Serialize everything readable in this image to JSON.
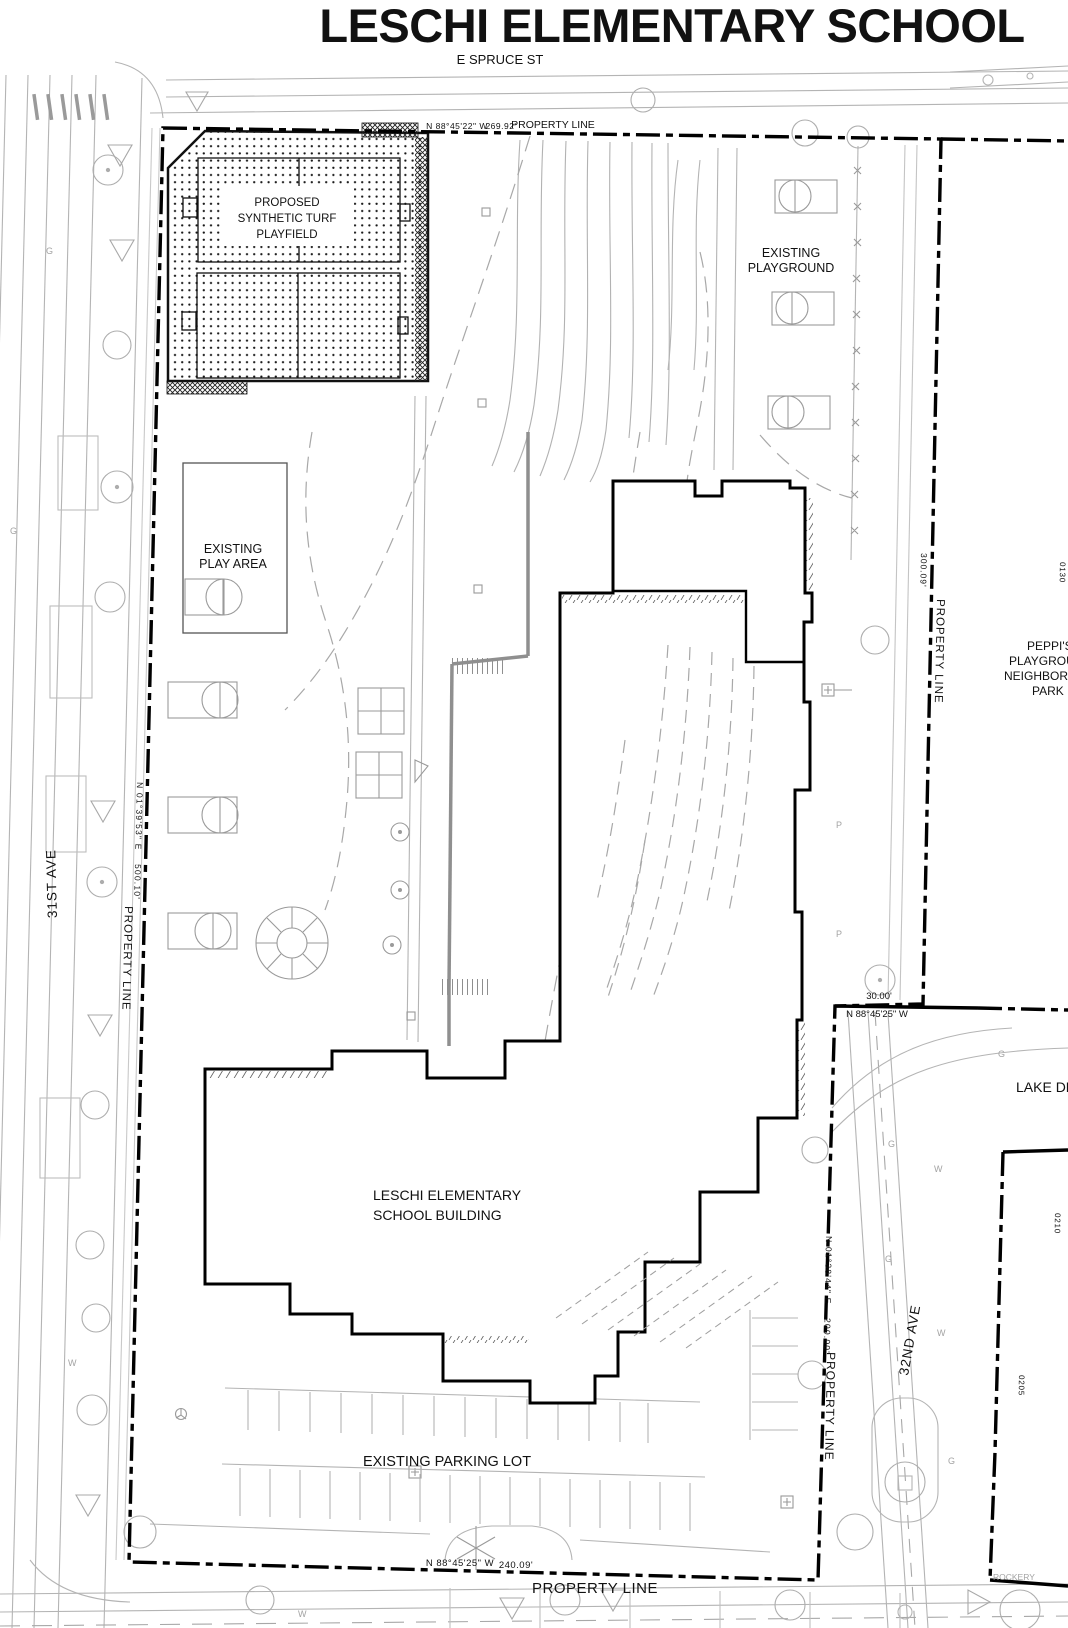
{
  "document": {
    "title": "LESCHI ELEMENTARY SCHOOL"
  },
  "streets": {
    "top": "E SPRUCE ST",
    "left": "31ST AVE",
    "right": "32ND AVE",
    "lake_dell_partial": "LAKE DEL"
  },
  "property_lines": {
    "north": {
      "bearing": "N 88°45'22\" W",
      "distance": "269.92'",
      "label": "PROPERTY LINE"
    },
    "west": {
      "bearing": "N 01°39'53\" E",
      "distance": "500.10'",
      "label": "PROPERTY LINE"
    },
    "east_upper": {
      "distance": "300.09'",
      "label": "PROPERTY LINE"
    },
    "east_jog": {
      "distance": "30.00'",
      "bearing": "N 88°45'25\" W"
    },
    "east_lower": {
      "bearing": "N 01°38'44\" E",
      "distance": "200.00'",
      "label": "PROPERTY LINE"
    },
    "south": {
      "bearing": "N 88°45'25\" W",
      "distance": "240.09'",
      "label": "PROPERTY LINE"
    }
  },
  "labels": {
    "playfield": {
      "line1": "PROPOSED",
      "line2": "SYNTHETIC TURF",
      "line3": "PLAYFIELD"
    },
    "playground": {
      "line1": "EXISTING",
      "line2": "PLAYGROUND"
    },
    "play_area": {
      "line1": "EXISTING",
      "line2": "PLAY AREA"
    },
    "building": {
      "line1": "LESCHI ELEMENTARY",
      "line2": "SCHOOL BUILDING"
    },
    "parking_lot": "EXISTING PARKING LOT",
    "park": {
      "line1": "PEPPI'S",
      "line2": "PLAYGROU",
      "line3": "NEIGHBORH",
      "line4": "PARK"
    },
    "rockery": "ROCKERY"
  },
  "parcel_numbers": [
    "0130",
    "0210",
    "0205"
  ],
  "utility_marks": {
    "gas": "G",
    "water": "W",
    "pole": "P"
  }
}
